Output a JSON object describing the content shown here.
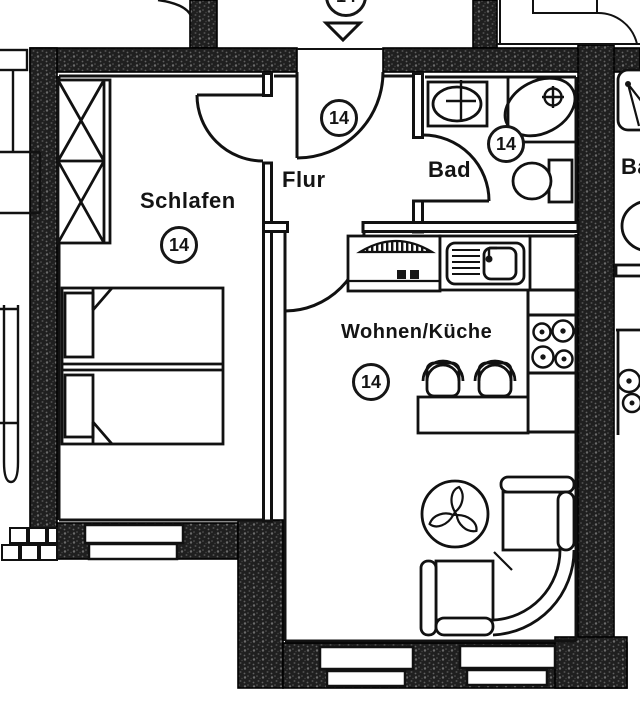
{
  "unit_number": "14",
  "rooms": {
    "schlafen": {
      "label": "Schlafen",
      "number": "14"
    },
    "flur": {
      "label": "Flur",
      "number": "14"
    },
    "bad": {
      "label": "Bad",
      "number": "14"
    },
    "wohnen_kueche": {
      "label": "Wohnen/Küche",
      "number": "14"
    }
  },
  "entrance": {
    "number": "14"
  },
  "neighbor_right": {
    "bad_label": "Bad"
  },
  "symbols": [
    "wardrobe",
    "double-bed",
    "entrance-door-arrow",
    "washbasin",
    "bathtub",
    "toilet",
    "kitchen-sink",
    "stove",
    "cooktop-4-burners",
    "table",
    "chairs",
    "corner-sofa",
    "plant",
    "windows",
    "brick-steps",
    "neighbor-shower",
    "neighbor-toilet",
    "neighbor-cooktop"
  ],
  "colors": {
    "wall_fill": "#1f1f1f",
    "wall_speckle": "#6b6b6b",
    "line": "#111111",
    "paper": "#ffffff"
  }
}
